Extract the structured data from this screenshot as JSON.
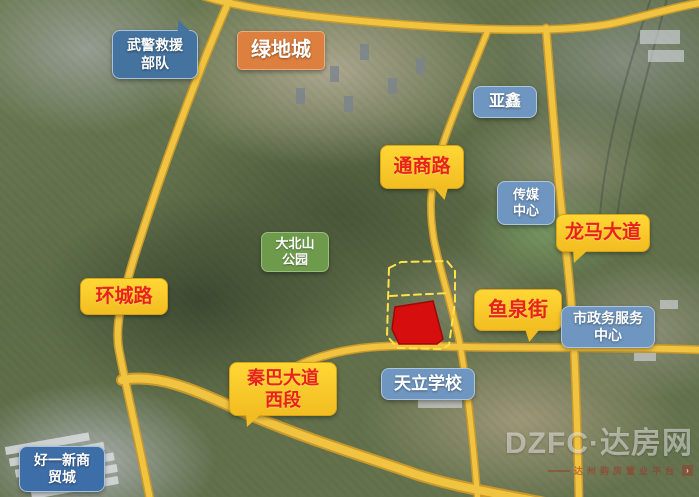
{
  "labels": {
    "rescue_troops_line1": "武警救援",
    "rescue_troops_line2": "部队",
    "greenland_city": "绿地城",
    "yaxin": "亚鑫",
    "tongshang_road": "通商路",
    "media_center_line1": "传媒",
    "media_center_line2": "中心",
    "longma_avenue": "龙马大道",
    "dabeishan_park_line1": "大北山",
    "dabeishan_park_line2": "公园",
    "huancheng_road": "环城路",
    "yuquan_street": "鱼泉街",
    "civic_service_center_line1": "市政务服务",
    "civic_service_center_line2": "中心",
    "qinba_avenue_line1": "秦巴大道",
    "qinba_avenue_line2": "西段",
    "tianli_school": "天立学校",
    "haoyixin_mall_line1": "好一新商",
    "haoyixin_mall_line2": "贸城"
  },
  "watermark": {
    "brand": "DZFC·达房网",
    "slogan": "达州购房置业平台"
  },
  "colors": {
    "road_fill": "#f0c441",
    "road_edge": "#c9992b",
    "bubble_yellow": "#ffd735",
    "bubble_text_red": "#e8231a",
    "label_blue": "#44739f",
    "label_blue_light": "#6f96c0",
    "label_green": "#6e9b4b",
    "label_orange": "#dd7f3e",
    "plot_red": "#d60e0e",
    "plot_dash_yellow": "#ffe24a"
  }
}
